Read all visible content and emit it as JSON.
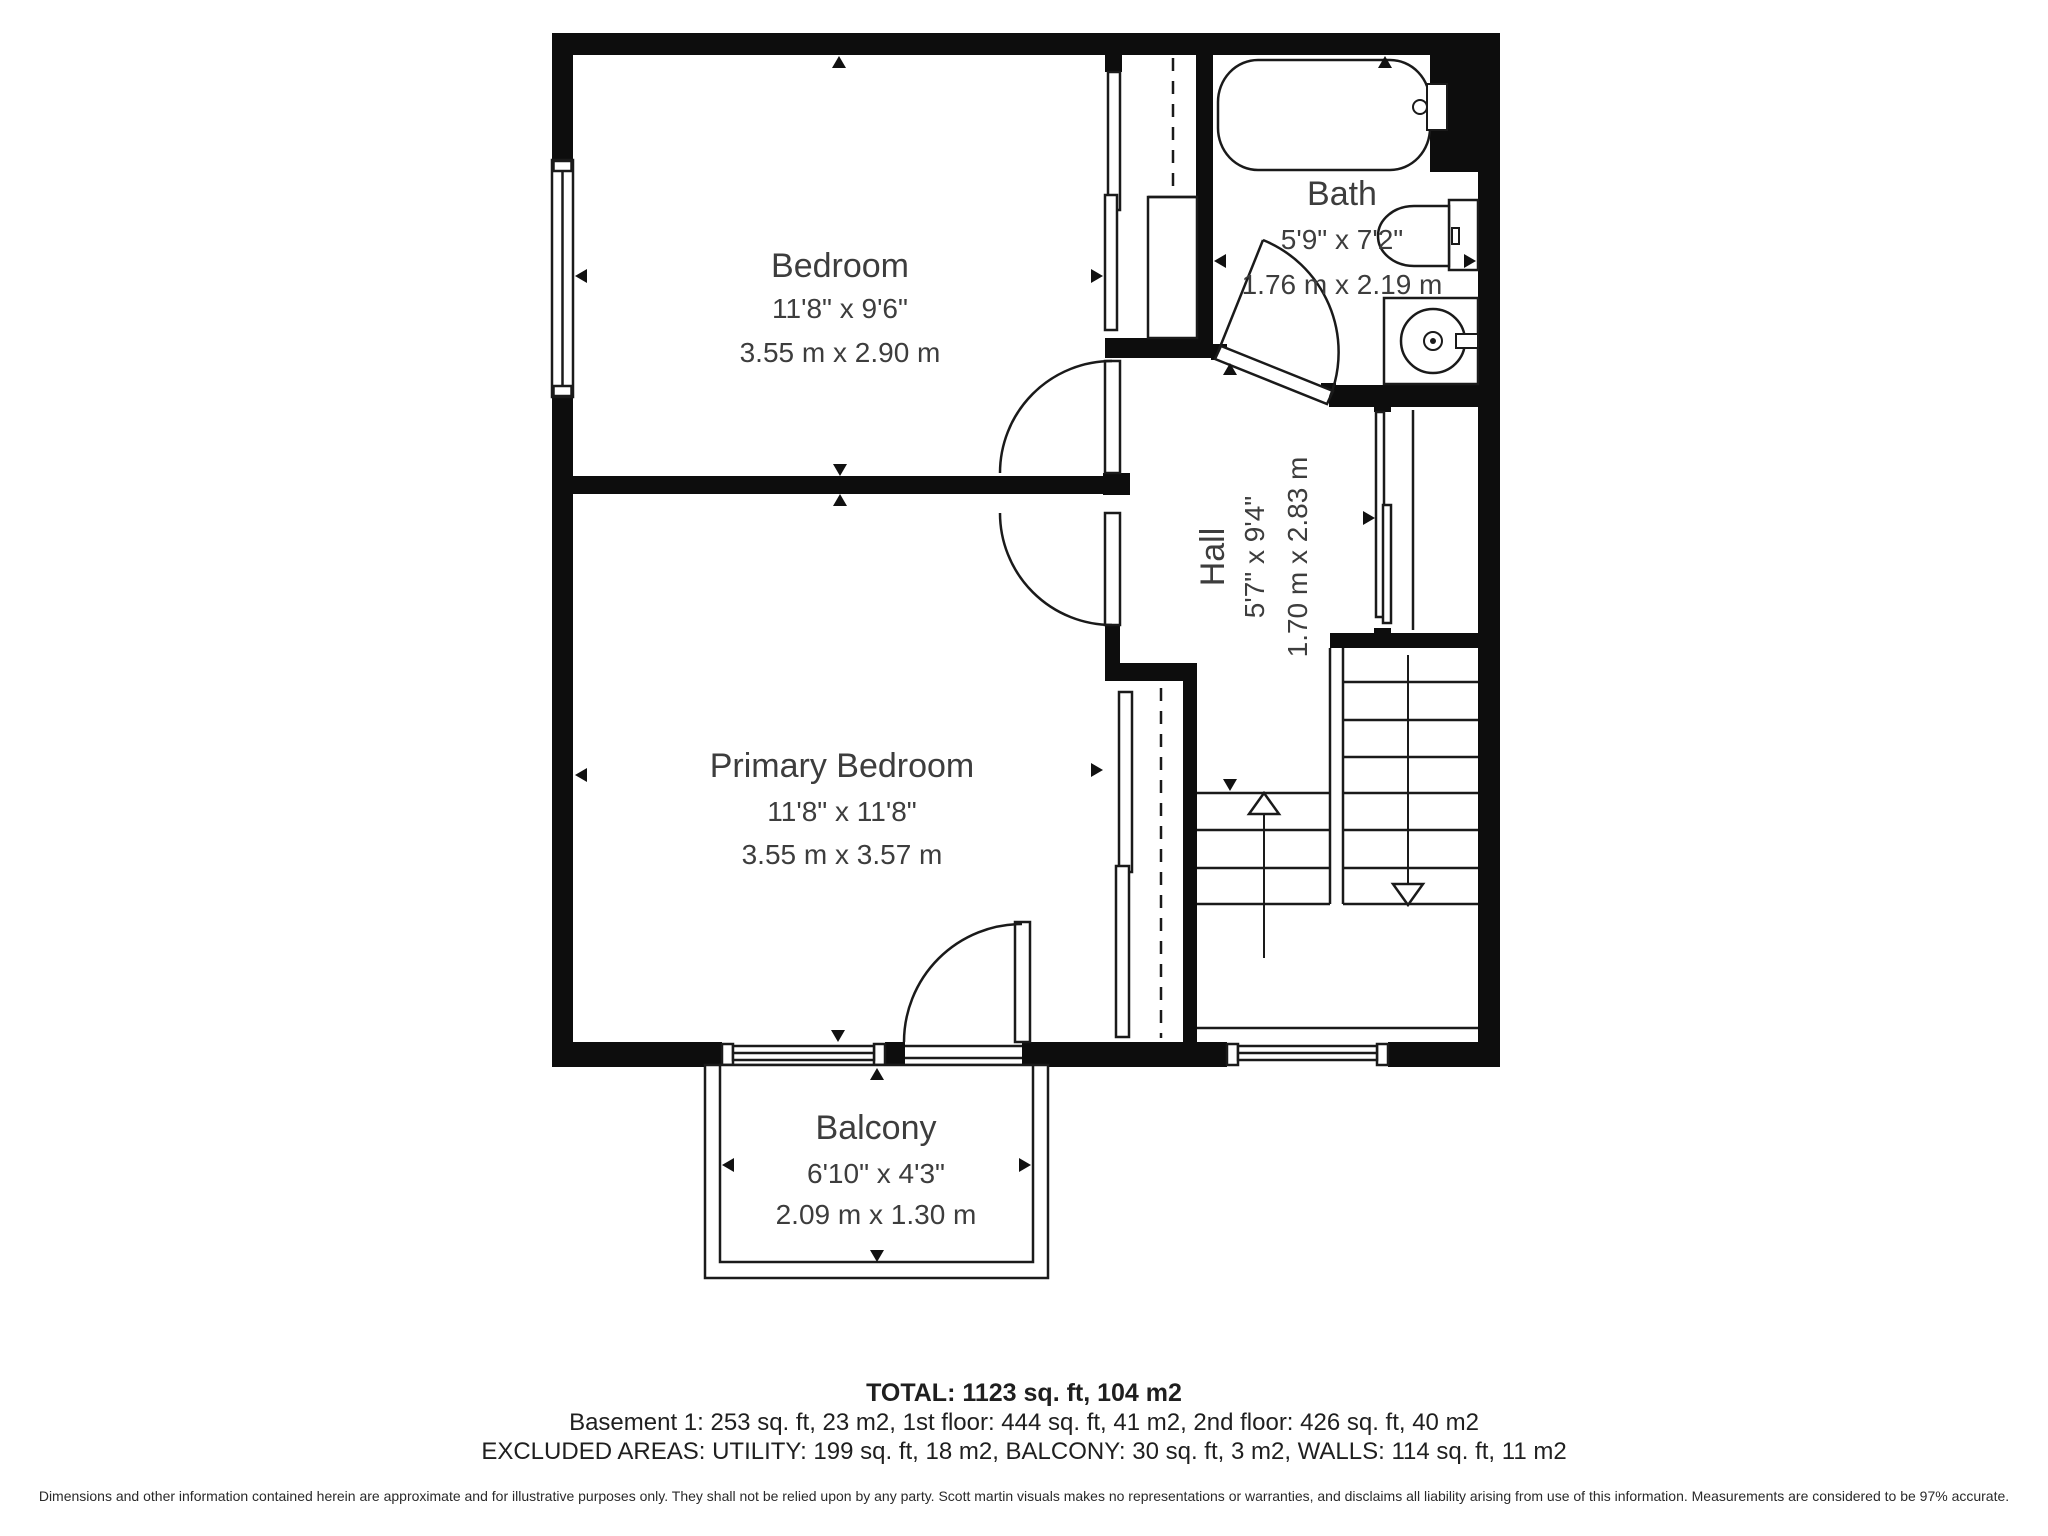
{
  "plan": {
    "floor_label": "2nd floor plan",
    "wall_color": "#0d0d0d",
    "line_color": "#1a1a1a",
    "text_color": "#3d3d3d",
    "background": "#ffffff"
  },
  "rooms": {
    "bedroom": {
      "name": "Bedroom",
      "imperial": "11'8\" x 9'6\"",
      "metric": "3.55 m x 2.90 m"
    },
    "bath": {
      "name": "Bath",
      "imperial": "5'9\" x 7'2\"",
      "metric": "1.76 m x 2.19 m"
    },
    "hall": {
      "name": "Hall",
      "imperial": "5'7\" x 9'4\"",
      "metric": "1.70 m x 2.83 m"
    },
    "primary_bedroom": {
      "name": "Primary Bedroom",
      "imperial": "11'8\" x 11'8\"",
      "metric": "3.55 m x 3.57 m"
    },
    "balcony": {
      "name": "Balcony",
      "imperial": "6'10\" x 4'3\"",
      "metric": "2.09 m x 1.30 m"
    }
  },
  "fixtures": [
    "bathtub",
    "toilet",
    "sink",
    "staircase",
    "closet",
    "doors",
    "windows"
  ],
  "summary": {
    "total": "TOTAL: 1123 sq. ft, 104 m2",
    "floors": "Basement 1: 253 sq. ft, 23 m2, 1st floor: 444 sq. ft, 41 m2, 2nd floor: 426 sq. ft, 40 m2",
    "excluded": "EXCLUDED AREAS: UTILITY: 199 sq. ft, 18 m2, BALCONY: 30 sq. ft, 3 m2, WALLS: 114 sq. ft, 11 m2",
    "disclaimer": "Dimensions and other information contained herein are approximate and for illustrative purposes only. They shall not be relied upon by any party. Scott martin visuals makes no representations or warranties, and disclaims all liability arising from use of this information. Measurements are considered to be 97% accurate."
  }
}
